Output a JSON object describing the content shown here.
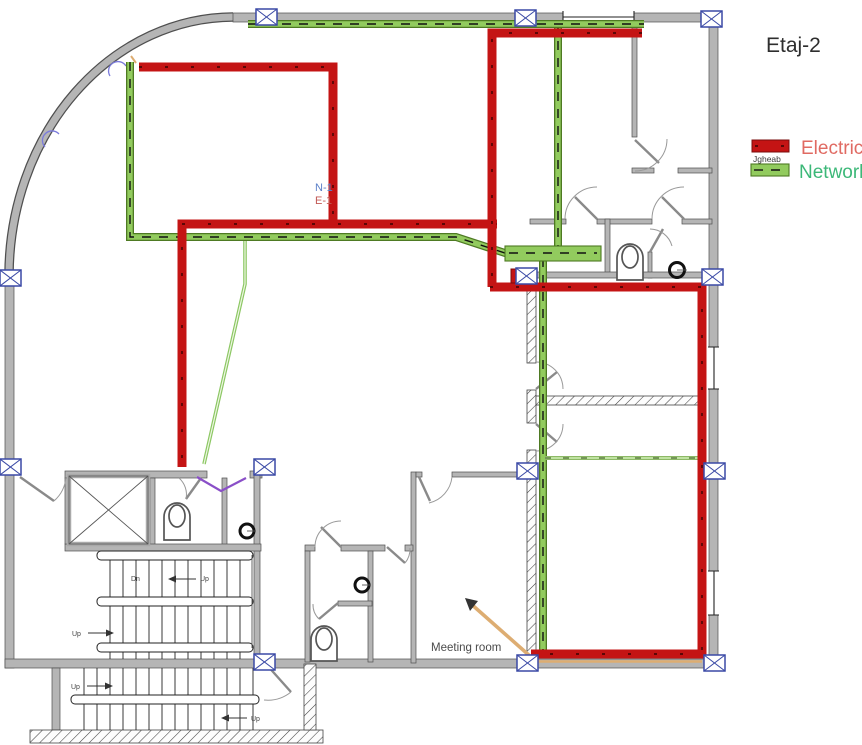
{
  "title": "Etaj-2",
  "legend": {
    "electric": "Electric",
    "network": "Network",
    "tray": "Jgheab"
  },
  "annotations": {
    "riser_network": "N-1",
    "riser_electric": "E-1",
    "meeting_room": "Meeting room",
    "up": "Up",
    "down": "Dn"
  },
  "colors": {
    "electric": "#c41414",
    "electric_text": "#e06a62",
    "network": "#92cb5e",
    "network_edge": "#4e7a23",
    "network_light": "#bfe2a1",
    "network_text": "#3cb878",
    "wall": "#b5b5b5",
    "wall_edge": "#4f4f4f",
    "column": "#3a49a5",
    "note_blue": "#5b80c8",
    "note_red": "#c25a55",
    "title_text": "#2e2e2e",
    "tray_orange": "#ddad72",
    "door_purple": "#8a4fc8"
  }
}
